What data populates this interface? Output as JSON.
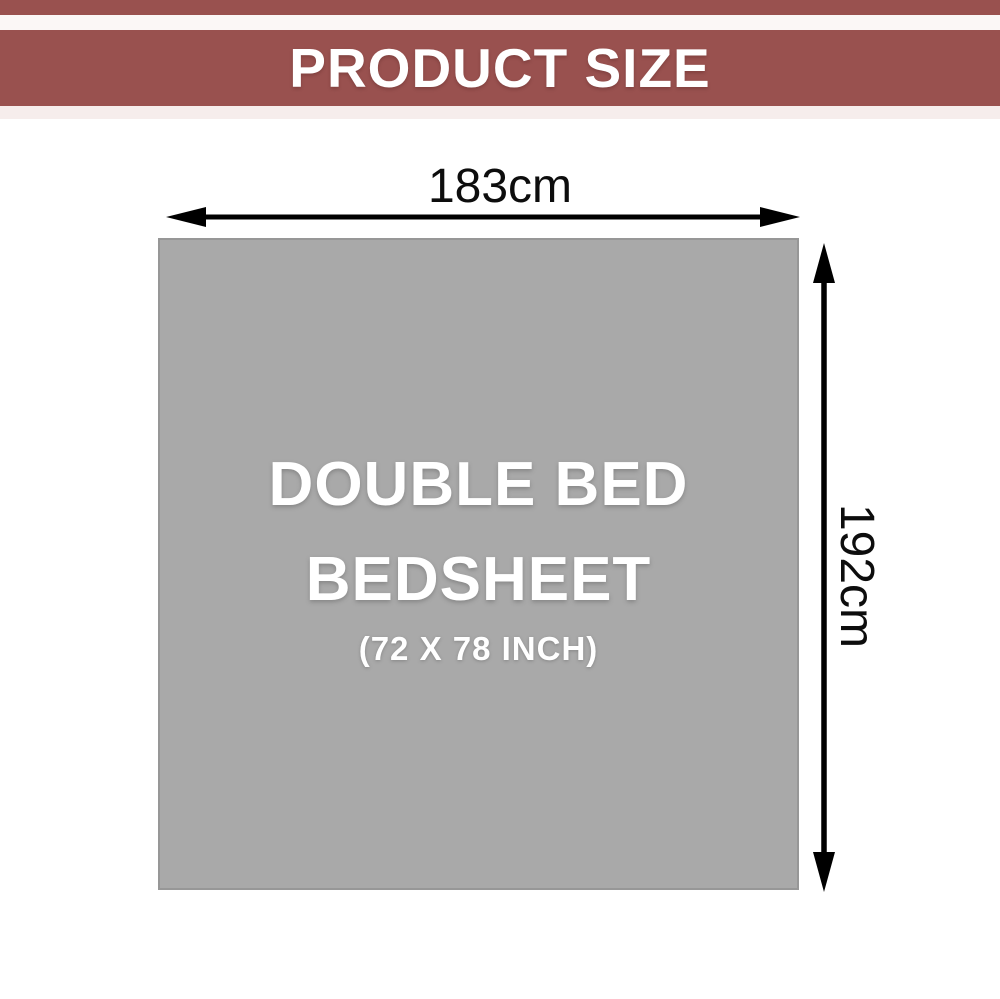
{
  "header": {
    "title": "PRODUCT SIZE",
    "band_color": "#99514f",
    "accent_strip_color": "#f6edec"
  },
  "product": {
    "line1": "DOUBLE BED",
    "line2": "BEDSHEET",
    "size_inches": "(72 X 78 INCH)",
    "sheet_color": "#a9a9a9",
    "text_color": "#ffffff"
  },
  "dimensions": {
    "width_label": "183cm",
    "height_label": "192cm",
    "arrow_color": "#000000"
  }
}
